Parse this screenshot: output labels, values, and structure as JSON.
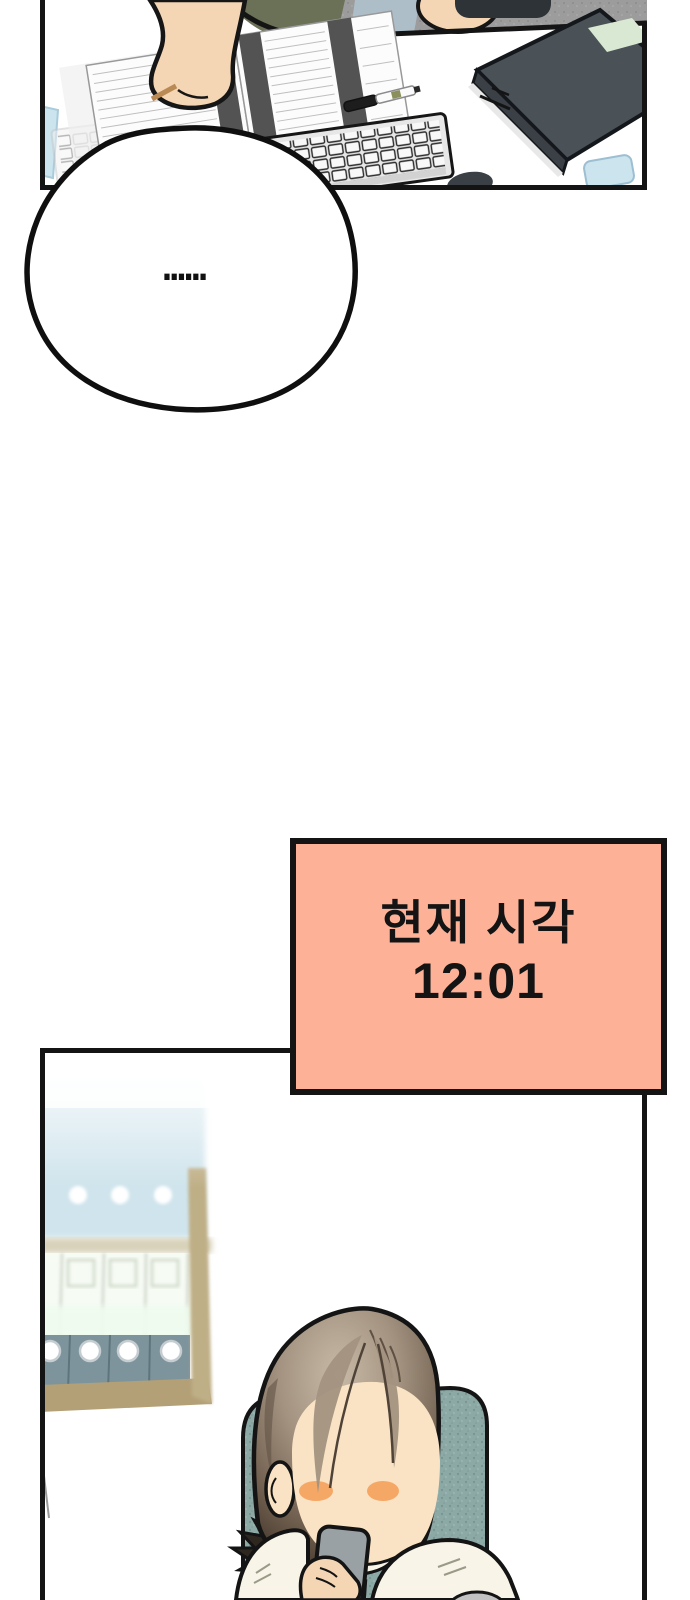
{
  "page": {
    "width": 690,
    "height": 1600
  },
  "speech_bubble": {
    "text": "……"
  },
  "time_box": {
    "line1": "현재 시각",
    "line2": "12:01"
  },
  "colors": {
    "page-bg": "#ffffff",
    "ink": "#141414",
    "time-box-bg": "#FDB298",
    "arm-skin": "#F5D6B4",
    "face-skin": "#FAE3C4",
    "blush": "#F5A866",
    "hair-top": "#C8B9A7",
    "hair-mid": "#A39280",
    "hair-deep": "#4A3D32",
    "ponytail": "#2E2720",
    "chair-teal": "#8CA9A6",
    "shirt": "#F8F5E8",
    "collar-green": "#44522F",
    "phone-gray": "#99A1A4",
    "binder-gray": "#7E949C",
    "binder-blue": "#B6D4DF",
    "shelf-tan": "#B3A077",
    "book-slate": "#4A5157",
    "book-label": "#D9E8D2",
    "floor-gray": "#9C9C9C",
    "divider-blue": "#AEBEC9",
    "clothes-olive": "#6A7156",
    "sticky-blue": "#CBE4EE",
    "doc-band": "#535353",
    "key-face": "#F8F8F8"
  }
}
